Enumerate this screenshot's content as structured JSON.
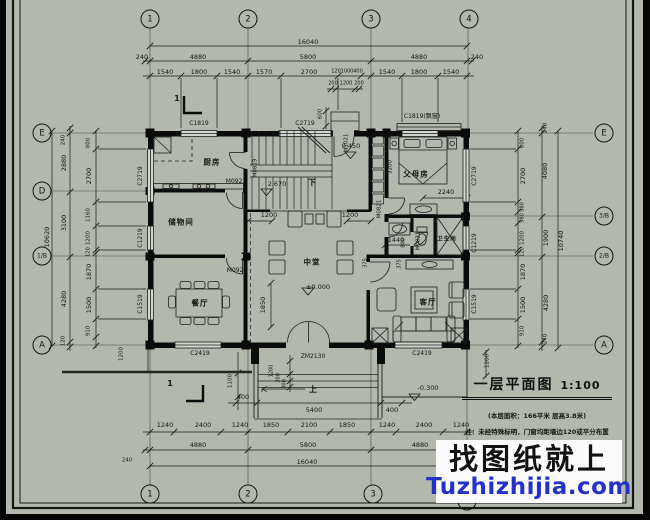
{
  "colors": {
    "sheet": "#b2b8ae",
    "line": "#1b1b1b",
    "wall": "#0b0b0b",
    "watermark_blue": "#2431c8"
  },
  "title_block": {
    "title": "一层平面图",
    "scale": "1:100",
    "note1": "(本层面积：166平米  层高3.8米)",
    "note2": "注：未经特殊标明，门窗均距墙边120或平分布置"
  },
  "watermark": {
    "line1": "找图纸就上",
    "line2": "Tuzhizhijia.com"
  },
  "bubbles": [
    {
      "t": "1",
      "x": 150,
      "y": 19
    },
    {
      "t": "2",
      "x": 248,
      "y": 19
    },
    {
      "t": "3",
      "x": 371,
      "y": 19
    },
    {
      "t": "4",
      "x": 469,
      "y": 19
    },
    {
      "t": "1",
      "x": 150,
      "y": 494
    },
    {
      "t": "2",
      "x": 248,
      "y": 494
    },
    {
      "t": "3",
      "x": 373,
      "y": 494
    },
    {
      "t": "4",
      "x": 467,
      "y": 501
    },
    {
      "t": "E",
      "x": 42,
      "y": 133
    },
    {
      "t": "D",
      "x": 42,
      "y": 191
    },
    {
      "t": "1/B",
      "x": 42,
      "y": 256,
      "s": 6
    },
    {
      "t": "A",
      "x": 42,
      "y": 345
    },
    {
      "t": "E",
      "x": 604,
      "y": 133
    },
    {
      "t": "3/B",
      "x": 604,
      "y": 216,
      "s": 6
    },
    {
      "t": "2/B",
      "x": 604,
      "y": 256,
      "s": 6
    },
    {
      "t": "A",
      "x": 604,
      "y": 345
    }
  ],
  "dims": [
    {
      "t": "16040",
      "x": 308,
      "y": 42
    },
    {
      "t": "240",
      "x": 142,
      "y": 57
    },
    {
      "t": "4880",
      "x": 198,
      "y": 57
    },
    {
      "t": "5800",
      "x": 308,
      "y": 57
    },
    {
      "t": "4880",
      "x": 419,
      "y": 57
    },
    {
      "t": "240",
      "x": 477,
      "y": 57
    },
    {
      "t": "1540",
      "x": 165,
      "y": 72
    },
    {
      "t": "1800",
      "x": 199,
      "y": 72
    },
    {
      "t": "1540",
      "x": 232,
      "y": 72
    },
    {
      "t": "1570",
      "x": 264,
      "y": 72
    },
    {
      "t": "2700",
      "x": 309,
      "y": 72
    },
    {
      "t": "120",
      "x": 336,
      "y": 72,
      "s": 5
    },
    {
      "t": "1000",
      "x": 347,
      "y": 72,
      "s": 5
    },
    {
      "t": "400",
      "x": 358,
      "y": 72,
      "s": 5
    },
    {
      "t": "1540",
      "x": 387,
      "y": 72
    },
    {
      "t": "1800",
      "x": 419,
      "y": 72
    },
    {
      "t": "1540",
      "x": 451,
      "y": 72
    },
    {
      "t": "200",
      "x": 333,
      "y": 84,
      "s": 5
    },
    {
      "t": "1200",
      "x": 346,
      "y": 84,
      "s": 5
    },
    {
      "t": "200",
      "x": 359,
      "y": 84,
      "s": 5
    },
    {
      "t": "600",
      "x": 321,
      "y": 114,
      "r": -90,
      "s": 5.5
    },
    {
      "t": "10620",
      "x": 47,
      "y": 237,
      "r": -90
    },
    {
      "t": "240",
      "x": 64,
      "y": 140,
      "r": -90,
      "s": 5.5
    },
    {
      "t": "2880",
      "x": 64,
      "y": 163,
      "r": -90
    },
    {
      "t": "3100",
      "x": 64,
      "y": 223,
      "r": -90
    },
    {
      "t": "4280",
      "x": 64,
      "y": 299,
      "r": -90
    },
    {
      "t": "120",
      "x": 64,
      "y": 341,
      "r": -90,
      "s": 5.5
    },
    {
      "t": "800",
      "x": 89,
      "y": 143,
      "r": -90,
      "s": 5.5
    },
    {
      "t": "2700",
      "x": 89,
      "y": 176,
      "r": -90
    },
    {
      "t": "1160",
      "x": 89,
      "y": 215,
      "r": -90,
      "s": 5.5
    },
    {
      "t": "1200",
      "x": 89,
      "y": 238,
      "r": -90,
      "s": 5.5
    },
    {
      "t": "120",
      "x": 89,
      "y": 252,
      "r": -90,
      "s": 5
    },
    {
      "t": "1870",
      "x": 89,
      "y": 272,
      "r": -90
    },
    {
      "t": "1500",
      "x": 89,
      "y": 305,
      "r": -90
    },
    {
      "t": "910",
      "x": 89,
      "y": 331,
      "r": -90,
      "s": 5.5
    },
    {
      "t": "1200",
      "x": 122,
      "y": 354,
      "r": -90,
      "s": 5.5
    },
    {
      "t": "800",
      "x": 523,
      "y": 143,
      "r": -90,
      "s": 5.5
    },
    {
      "t": "2700",
      "x": 523,
      "y": 176,
      "r": -90
    },
    {
      "t": "580",
      "x": 523,
      "y": 207,
      "r": -90,
      "s": 5
    },
    {
      "t": "580",
      "x": 523,
      "y": 218,
      "r": -90,
      "s": 5
    },
    {
      "t": "1200",
      "x": 523,
      "y": 238,
      "r": -90,
      "s": 5.5
    },
    {
      "t": "120",
      "x": 523,
      "y": 252,
      "r": -90,
      "s": 5
    },
    {
      "t": "1870",
      "x": 523,
      "y": 272,
      "r": -90
    },
    {
      "t": "1500",
      "x": 523,
      "y": 305,
      "r": -90
    },
    {
      "t": "910",
      "x": 523,
      "y": 331,
      "r": -90,
      "s": 5.5
    },
    {
      "t": "240",
      "x": 546,
      "y": 128,
      "r": -90,
      "s": 5.5
    },
    {
      "t": "4080",
      "x": 545,
      "y": 171,
      "r": -90
    },
    {
      "t": "1900",
      "x": 546,
      "y": 238,
      "r": -90
    },
    {
      "t": "10740",
      "x": 561,
      "y": 241,
      "r": -90
    },
    {
      "t": "4280",
      "x": 546,
      "y": 303,
      "r": -90
    },
    {
      "t": "240",
      "x": 546,
      "y": 339,
      "r": -90,
      "s": 5.5
    },
    {
      "t": "1200",
      "x": 488,
      "y": 361,
      "r": -90,
      "s": 5.5
    },
    {
      "t": "1100",
      "x": 231,
      "y": 381,
      "r": -90,
      "s": 5.5
    },
    {
      "t": "400",
      "x": 243,
      "y": 397
    },
    {
      "t": "5400",
      "x": 314,
      "y": 410
    },
    {
      "t": "400",
      "x": 392,
      "y": 410
    },
    {
      "t": "1200",
      "x": 272,
      "y": 371,
      "r": -90,
      "s": 5
    },
    {
      "t": "300",
      "x": 279,
      "y": 378,
      "r": -90,
      "s": 5
    },
    {
      "t": "300",
      "x": 285,
      "y": 384,
      "r": -90,
      "s": 5
    },
    {
      "t": "240",
      "x": 127,
      "y": 461,
      "s": 5.5
    },
    {
      "t": "1240",
      "x": 165,
      "y": 425
    },
    {
      "t": "2400",
      "x": 203,
      "y": 425
    },
    {
      "t": "1240",
      "x": 240,
      "y": 425
    },
    {
      "t": "1850",
      "x": 271,
      "y": 425
    },
    {
      "t": "2100",
      "x": 309,
      "y": 425
    },
    {
      "t": "1850",
      "x": 347,
      "y": 425
    },
    {
      "t": "1240",
      "x": 387,
      "y": 425
    },
    {
      "t": "2400",
      "x": 424,
      "y": 425
    },
    {
      "t": "1240",
      "x": 461,
      "y": 425
    },
    {
      "t": "4880",
      "x": 198,
      "y": 445
    },
    {
      "t": "5800",
      "x": 308,
      "y": 445
    },
    {
      "t": "4880",
      "x": 420,
      "y": 445
    },
    {
      "t": "16040",
      "x": 307,
      "y": 462
    },
    {
      "t": "1200",
      "x": 269,
      "y": 215
    },
    {
      "t": "1200",
      "x": 350,
      "y": 215
    },
    {
      "t": "1440",
      "x": 396,
      "y": 240
    },
    {
      "t": "2240",
      "x": 446,
      "y": 192
    },
    {
      "t": "1850",
      "x": 263,
      "y": 305,
      "r": -90
    },
    {
      "t": "3200",
      "x": 391,
      "y": 167,
      "r": -90,
      "s": 5.5
    },
    {
      "t": "800",
      "x": 404,
      "y": 243,
      "r": -90,
      "s": 5
    },
    {
      "t": "375",
      "x": 400,
      "y": 264,
      "r": -90,
      "s": 5
    },
    {
      "t": "375",
      "x": 366,
      "y": 263,
      "r": -90,
      "s": 5
    }
  ],
  "openings": [
    {
      "t": "C1819",
      "x": 199,
      "y": 124
    },
    {
      "t": "C2719",
      "x": 305,
      "y": 124
    },
    {
      "t": "M1021",
      "x": 347,
      "y": 143,
      "r": -90,
      "s": 5.5
    },
    {
      "t": "C1819(飘窗)",
      "x": 422,
      "y": 117
    },
    {
      "t": "C2719",
      "x": 141,
      "y": 176,
      "r": -90
    },
    {
      "t": "C1219",
      "x": 141,
      "y": 238,
      "r": -90
    },
    {
      "t": "C1519",
      "x": 141,
      "y": 304,
      "r": -90
    },
    {
      "t": "C2719",
      "x": 475,
      "y": 176,
      "r": -90
    },
    {
      "t": "C1219",
      "x": 475,
      "y": 243,
      "r": -90
    },
    {
      "t": "C1519",
      "x": 475,
      "y": 304,
      "r": -90
    },
    {
      "t": "C2419",
      "x": 200,
      "y": 354
    },
    {
      "t": "ZM2130",
      "x": 313,
      "y": 357
    },
    {
      "t": "C2419",
      "x": 422,
      "y": 354
    },
    {
      "t": "M0921",
      "x": 236,
      "y": 182
    },
    {
      "t": "M0921",
      "x": 237,
      "y": 271
    },
    {
      "t": "M0819",
      "x": 256,
      "y": 168,
      "r": -90,
      "s": 5.5
    },
    {
      "t": "M0821",
      "x": 380,
      "y": 209,
      "r": -90,
      "s": 5.5
    },
    {
      "t": "M0821",
      "x": 419,
      "y": 241,
      "r": -90,
      "s": 5.5
    }
  ],
  "rooms": [
    {
      "t": "厨房",
      "x": 212,
      "y": 162
    },
    {
      "t": "储物间",
      "x": 181,
      "y": 222
    },
    {
      "t": "餐厅",
      "x": 200,
      "y": 303
    },
    {
      "t": "中堂",
      "x": 312,
      "y": 262
    },
    {
      "t": "父母房",
      "x": 416,
      "y": 174
    },
    {
      "t": "卫生间",
      "x": 447,
      "y": 240,
      "s": 5.5
    },
    {
      "t": "客厅",
      "x": 428,
      "y": 302
    }
  ],
  "levels": [
    {
      "t": "2.670",
      "x": 277,
      "y": 184
    },
    {
      "t": "0.450",
      "x": 351,
      "y": 146
    },
    {
      "t": "±0.000",
      "x": 318,
      "y": 287
    },
    {
      "t": "-0.300",
      "x": 428,
      "y": 388
    }
  ],
  "marks": [
    {
      "t": "下",
      "x": 312,
      "y": 183
    },
    {
      "t": "上",
      "x": 313,
      "y": 390
    },
    {
      "t": "1",
      "x": 177,
      "y": 99
    },
    {
      "t": "1",
      "x": 170,
      "y": 384
    }
  ]
}
